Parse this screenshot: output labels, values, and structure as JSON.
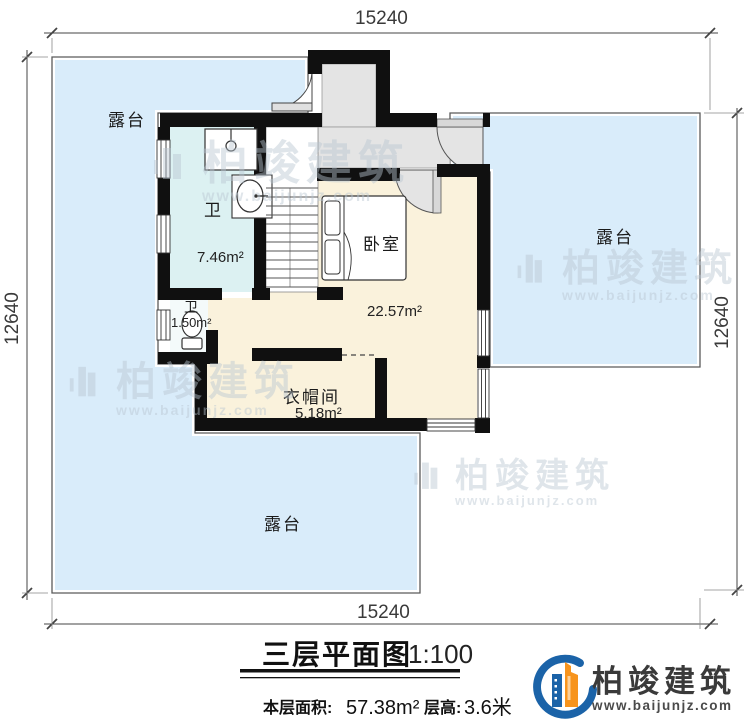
{
  "drawing": {
    "type": "floor-plan",
    "colors": {
      "terrace_fill": "#d9ecfa",
      "floor_fill": "#faf2dc",
      "bath_fill": "#dcf1f2",
      "hall_fill": "#e4e4e4",
      "wall": "#101010",
      "watermark": "#b9c6d2",
      "logo_blue": "#1b63a8",
      "logo_orange": "#f7941d"
    }
  },
  "dimensions": {
    "top": "15240",
    "bottom": "15240",
    "left": "12640",
    "right": "12640"
  },
  "rooms": {
    "terrace_top_left": {
      "label": "露台"
    },
    "terrace_right": {
      "label": "露台"
    },
    "terrace_bottom": {
      "label": "露台"
    },
    "bath_main": {
      "label": "卫",
      "area": "7.46m²"
    },
    "bath_small": {
      "label": "卫",
      "area": "1.50m²"
    },
    "bedroom": {
      "label": "卧室",
      "area": "22.57m²"
    },
    "cloakroom": {
      "label": "衣帽间",
      "area": "5.18m²"
    }
  },
  "watermark": {
    "brand": "柏竣建筑",
    "url": "www.baijunjz.com"
  },
  "title_block": {
    "title": "三层平面图",
    "scale": "1:100",
    "floor_area_label": "本层面积:",
    "floor_area_value": "57.38m²",
    "height_label": "层高:",
    "height_value": "3.6米"
  },
  "logo": {
    "brand": "柏竣建筑",
    "url": "www.baijunjz.com"
  }
}
